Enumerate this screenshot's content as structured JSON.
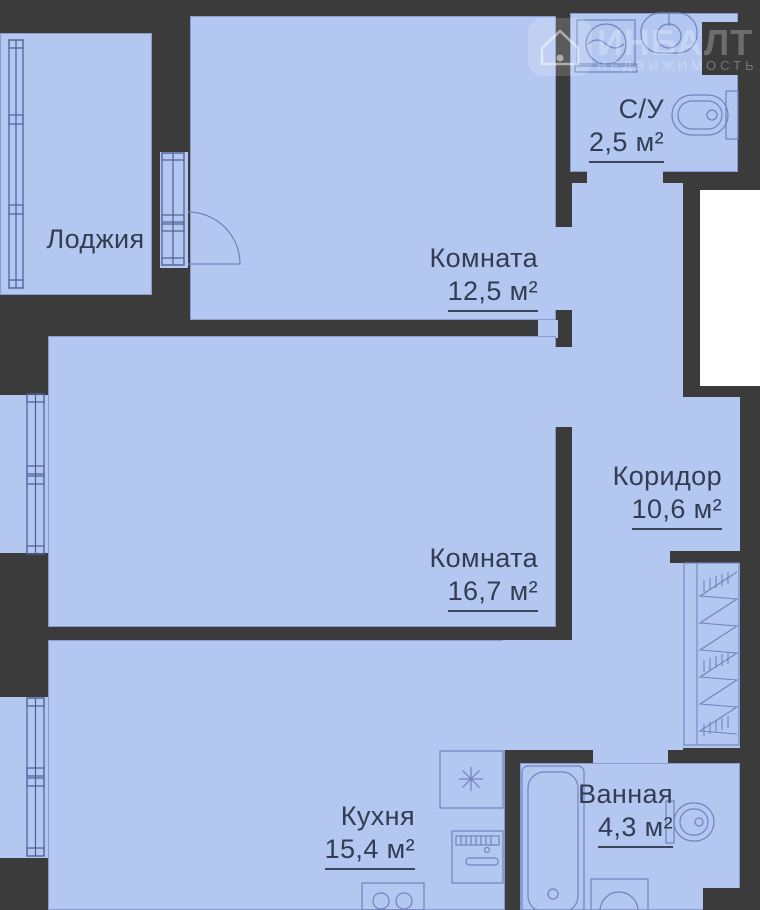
{
  "watermark": {
    "brand": "ИНБАЛТ",
    "tagline": "НЕДВИЖИМОСТЬ",
    "icon": "house-icon"
  },
  "plan": {
    "type": "apartment-floor-plan",
    "rooms": [
      {
        "key": "loggia",
        "label": "Лоджия",
        "area": ""
      },
      {
        "key": "room_a",
        "label": "Комната",
        "area": "12,5 м²"
      },
      {
        "key": "wc",
        "label": "С/У",
        "area": "2,5 м²"
      },
      {
        "key": "room_b",
        "label": "Комната",
        "area": "16,7 м²"
      },
      {
        "key": "corridor",
        "label": "Коридор",
        "area": "10,6 м²"
      },
      {
        "key": "kitchen",
        "label": "Кухня",
        "area": "15,4 м²"
      },
      {
        "key": "bathroom",
        "label": "Ванная",
        "area": "4,3 м²"
      }
    ],
    "colors": {
      "wall": "#3b3b3b",
      "floor": "#b4c7f0",
      "window_line": "#4d5e96",
      "fixture_line": "#6f84bd",
      "text": "#333c52",
      "shaft": "#ffffff"
    },
    "icons": [
      "window-icon",
      "balcony-door-swing-icon",
      "washing-machine-icon",
      "sink-icon",
      "toilet-icon",
      "wardrobe-icon",
      "bathtub-icon",
      "cooktop-icon",
      "oven-icon",
      "burners-icon",
      "house-icon"
    ]
  }
}
